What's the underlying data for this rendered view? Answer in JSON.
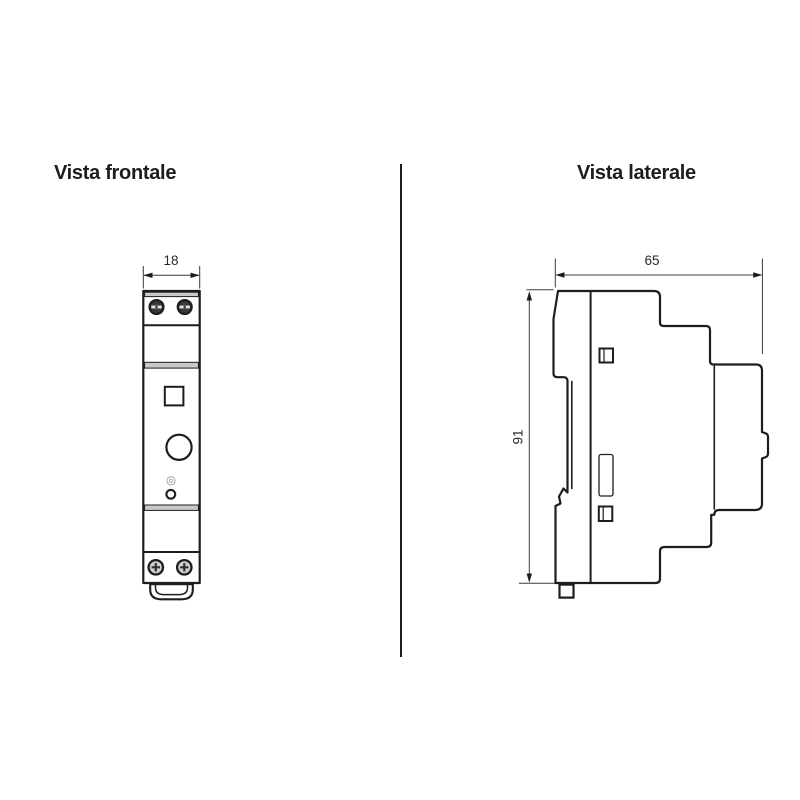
{
  "page": {
    "type": "technical-dimension-drawing",
    "background": "#ffffff"
  },
  "front_view": {
    "title": "Vista frontale",
    "width_label": "18"
  },
  "side_view": {
    "title": "Vista laterale",
    "width_label": "65",
    "height_label": "91"
  },
  "colors": {
    "line": "#1d1d1b",
    "band_gray": "#c9c9c9",
    "dimension_line": "#3a3a3a",
    "screw_dark": "#3a3a3a",
    "screw_light": "#d9d9d9",
    "background": "#ffffff"
  }
}
